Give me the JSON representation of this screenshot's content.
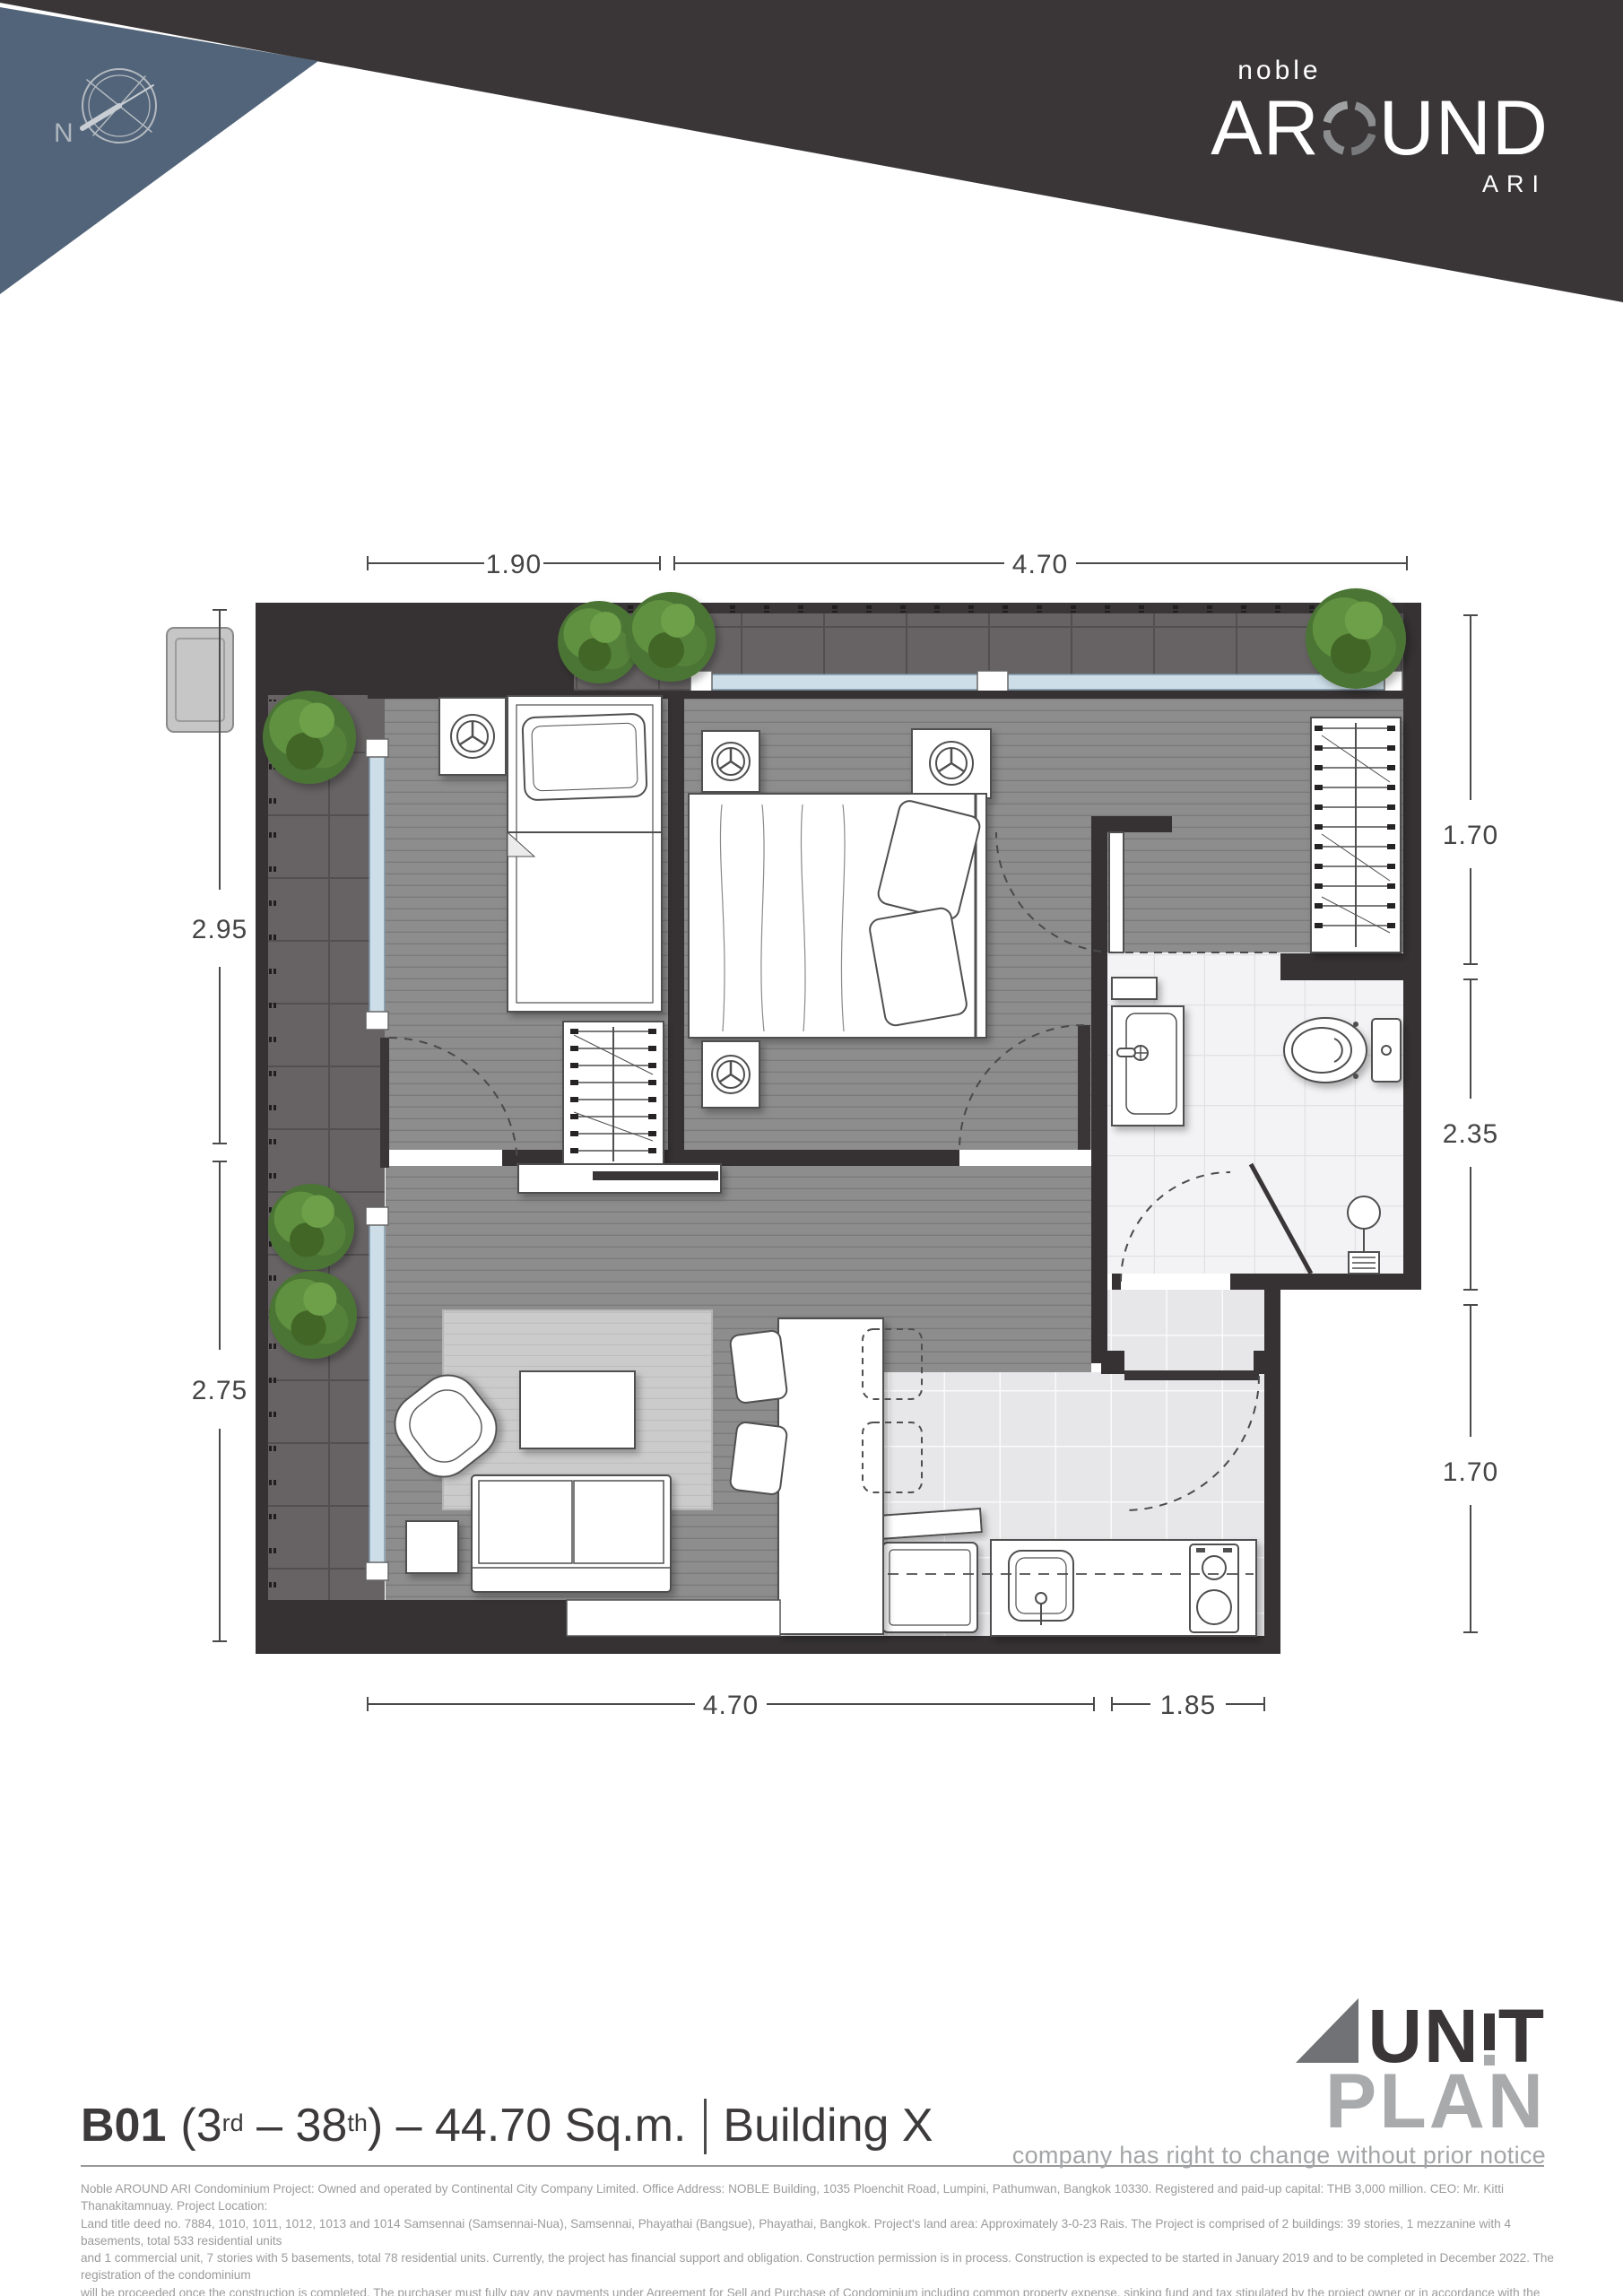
{
  "header": {
    "compass_label": "N",
    "brand": {
      "small": "noble",
      "large_left": "AR",
      "large_right": "UND",
      "sub": "ARI"
    },
    "colors": {
      "band": "#3a3637",
      "wedge": "#526479"
    }
  },
  "plan": {
    "dimensions": {
      "top_left": "1.90",
      "top_right": "4.70",
      "left_upper": "2.95",
      "left_lower": "2.75",
      "right_upper": "1.70",
      "right_middle": "2.35",
      "right_lower": "1.70",
      "bottom_left": "4.70",
      "bottom_right": "1.85"
    }
  },
  "footer": {
    "unit": {
      "code": "B01",
      "seg_open": "(3",
      "sup_from": "rd",
      "seg_mid": " – 38",
      "sup_to": "th",
      "seg_close": ") – 44.70 Sq.m.",
      "building": "Building X"
    },
    "unitplan_logo": {
      "un": "UN",
      "t": "T",
      "plan": "PLAN",
      "tagline": "company has right to change without prior notice"
    },
    "disclaimer_lines": [
      "Noble AROUND ARI Condominium Project: Owned and operated by Continental City Company Limited. Office Address: NOBLE Building, 1035 Ploenchit Road, Lumpini, Pathumwan, Bangkok 10330. Registered and paid-up capital: THB 3,000 million. CEO: Mr. Kitti Thanakitamnuay. Project Location:",
      "Land title deed no. 7884, 1010, 1011, 1012, 1013 and 1014 Samsennai (Samsennai-Nua), Samsennai, Phayathai (Bangsue), Phayathai, Bangkok. Project's land area: Approximately 3-0-23 Rais. The Project is comprised of 2 buildings: 39 stories, 1 mezzanine with 4 basements, total 533 residential units",
      "and 1 commercial unit, 7 stories with 5 basements, total 78 residential units. Currently, the project has financial support and obligation. Construction permission is in process. Construction is expected to be started in January 2019 and to be completed in December 2022. The registration of the condominium",
      "will be proceeded once the construction is completed. The purchaser must fully pay any payments under Agreement for Sell and Purchase of Condominium including common property expense, sinking fund and tax stipulated by the project owner or in accordance with the regulation of the Condominium",
      "Juristic Person. Remark: Reserve the right to change all information without prior notice. Simulated images for commercial only."
    ]
  }
}
